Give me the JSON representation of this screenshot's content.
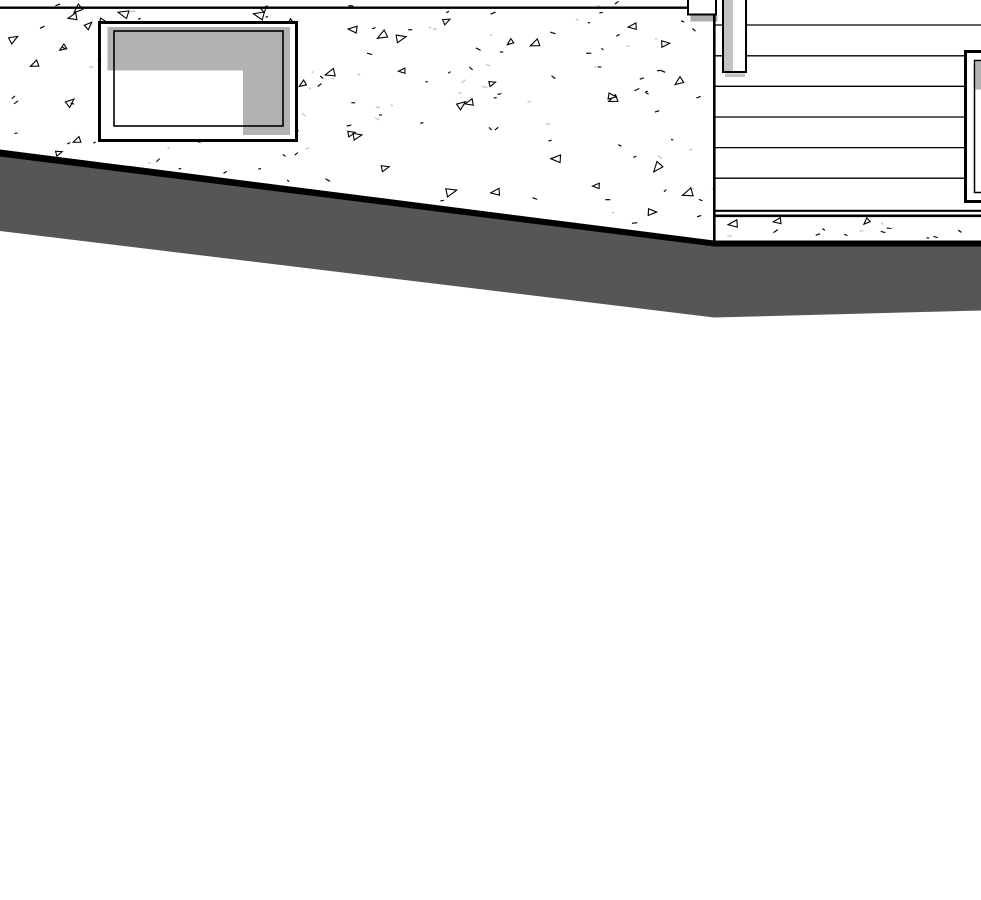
{
  "view": {
    "type": "architectural-elevation-drawing",
    "width": 981,
    "height": 900,
    "background": "#ffffff"
  },
  "palette": {
    "line": "#000000",
    "white": "#ffffff",
    "earth_gray": "#565656",
    "glass_gray": "#b2b2b2",
    "post_shade_gray": "#c2c2c2",
    "shadow_gray": "#aeaeae",
    "faint_mark_gray": "#bdbdbd"
  },
  "scene": {
    "concrete_wall": {
      "polygon": [
        [
          0,
          0
        ],
        [
          714,
          0
        ],
        [
          714,
          244
        ],
        [
          0,
          152
        ]
      ],
      "joint_line": {
        "x": 0,
        "y": 6.5,
        "w": 688,
        "h": 2.4
      }
    },
    "beam_end": {
      "rect": {
        "x": 688,
        "y": -2,
        "w": 28,
        "h": 16.5,
        "stroke_w": 2
      },
      "shadow": {
        "x": 690.5,
        "y": 15.5,
        "w": 27,
        "h": 6
      }
    },
    "corner_line": {
      "x": 713,
      "y": 14,
      "w": 2.6,
      "h": 230
    },
    "basement_window": {
      "outer": {
        "x": 99.5,
        "y": 22.5,
        "w": 197,
        "h": 118,
        "stroke_w": 3
      },
      "sash": {
        "x": 107.5,
        "y": 27,
        "w": 182.5,
        "h": 108
      },
      "reflection": {
        "x": 107.5,
        "y": 70.5,
        "w": 135.5,
        "h": 64.5
      },
      "inner": {
        "x": 114,
        "y": 31,
        "w": 169,
        "h": 95,
        "stroke_w": 1.6
      }
    },
    "siding": {
      "x1": 715.5,
      "x2": 981,
      "line_ys": [
        25,
        55.8,
        86.3,
        117,
        147.6,
        178.2
      ],
      "line_w": 1.3,
      "trim_lines": [
        {
          "x1": 713,
          "x2": 981,
          "y": 210.8,
          "w": 2.2
        },
        {
          "x1": 713,
          "x2": 981,
          "y": 215.8,
          "w": 2.6
        }
      ]
    },
    "post": {
      "rect": {
        "x": 723,
        "y": -4,
        "w": 23,
        "h": 76,
        "stroke_w": 2
      },
      "shade": {
        "x": 724,
        "y": -2,
        "w": 9,
        "h": 73
      },
      "shadow": {
        "x": 725,
        "y": 73.5,
        "w": 20,
        "h": 3.5
      }
    },
    "right_window": {
      "outer": {
        "x": 965.5,
        "y": 51.5,
        "w": 20,
        "h": 150,
        "stroke_w": 3
      },
      "inner": {
        "x": 974.5,
        "y": 60.5,
        "w": 12,
        "h": 132,
        "stroke_w": 1.5
      },
      "glass": {
        "x": 975.5,
        "y": 61.5,
        "w": 10,
        "h": 28
      }
    },
    "foundation_strip": {
      "x": 714,
      "y": 216,
      "w": 267,
      "h": 27
    },
    "grade_band": {
      "black_edge_polygon": [
        [
          0,
          149.5
        ],
        [
          714,
          240.5
        ],
        [
          981,
          240.5
        ],
        [
          981,
          247
        ],
        [
          714,
          247.5
        ],
        [
          0,
          157
        ]
      ],
      "earth_polygon": [
        [
          0,
          156.5
        ],
        [
          714,
          246.5
        ],
        [
          981,
          246.5
        ],
        [
          981,
          310.5
        ],
        [
          714,
          317.5
        ],
        [
          0,
          231
        ]
      ]
    },
    "stipple": {
      "seed": 1337,
      "wall": {
        "count": 185,
        "triangle_ratio": 0.26
      },
      "foundation": {
        "count": 15,
        "triangle_ratio": 0.2
      },
      "dash_len_min": 2.2,
      "dash_len_max": 5.6,
      "tri_size_min": 6.5,
      "tri_size_max": 11,
      "faint_dash_ratio": 0.28
    }
  }
}
